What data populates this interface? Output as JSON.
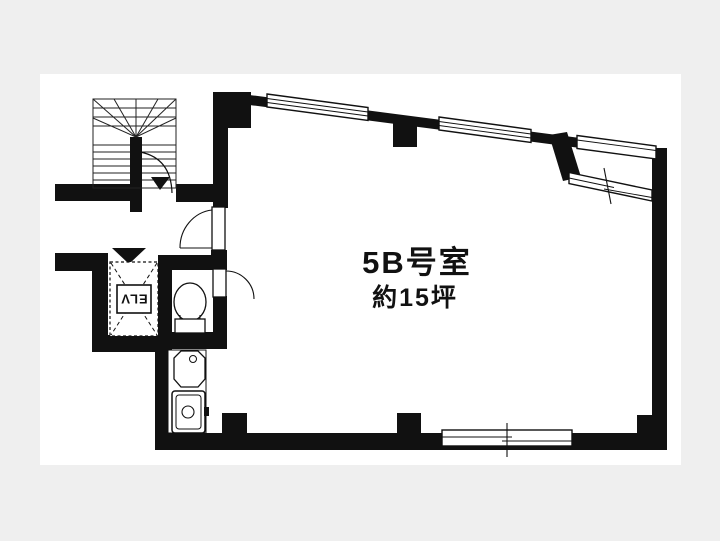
{
  "page": {
    "background": "#efefef",
    "paper": "#ffffff",
    "ink": "#111111"
  },
  "room": {
    "name": "5B号室",
    "area": "約15坪"
  },
  "elevator": {
    "label": "ELV"
  }
}
